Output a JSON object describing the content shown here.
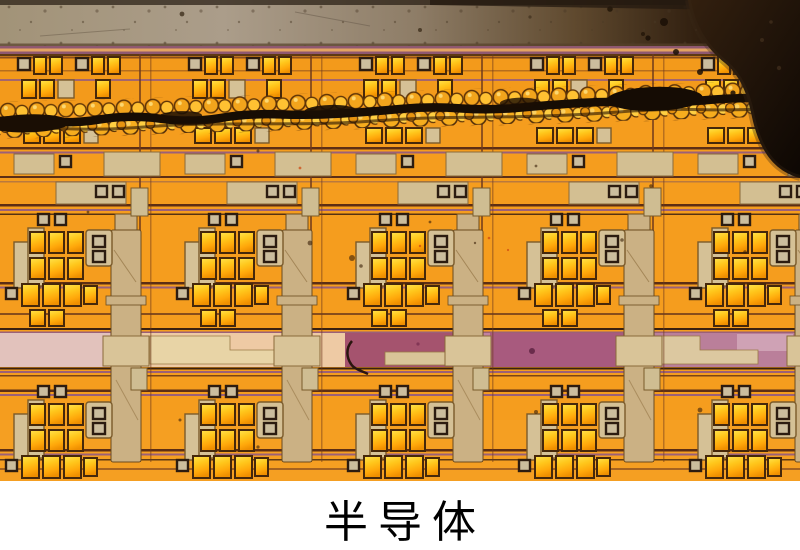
{
  "figure": {
    "type": "photograph",
    "subject": "Optical microscope close-up of a semiconductor integrated circuit die",
    "caption": "半导体"
  },
  "colors": {
    "page_background": "#ffffff",
    "caption_text": "#000000",
    "die_orange": "#f59d1e",
    "pad_yellow": "#ffc71c",
    "pad_beige": "#d5c196",
    "tower_tan": "#cbb184",
    "top_edge_gray": "#a59681",
    "seal_mauve": "#9b6078",
    "wire_brown": "#5d2e14",
    "band_peach": "#eecaa4",
    "band_pink": "#e2c2bc",
    "band_maroon": "#a5536e",
    "band_mauve": "#ba7f9a",
    "crack_dark": "#170d04",
    "debris_dark": "#150c04"
  }
}
